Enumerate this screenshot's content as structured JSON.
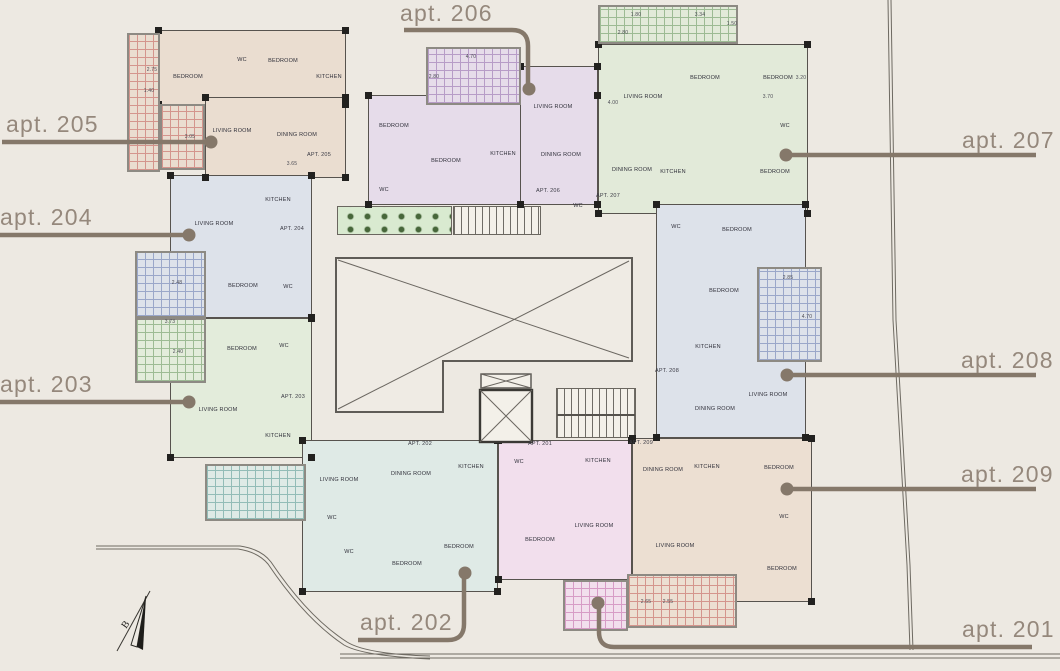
{
  "page": {
    "background": "#EDE9E2"
  },
  "callouts": [
    {
      "id": "205",
      "label": "apt. 205"
    },
    {
      "id": "204",
      "label": "apt. 204"
    },
    {
      "id": "203",
      "label": "apt. 203"
    },
    {
      "id": "206",
      "label": "apt. 206"
    },
    {
      "id": "207",
      "label": "apt. 207"
    },
    {
      "id": "208",
      "label": "apt. 208"
    },
    {
      "id": "209",
      "label": "apt. 209"
    },
    {
      "id": "202",
      "label": "apt. 202"
    },
    {
      "id": "201",
      "label": "apt. 201"
    }
  ],
  "compass": {
    "label": "B"
  },
  "units": [
    {
      "id": "apt-205",
      "fill": "#EADDD0",
      "rects": [
        [
          158,
          30,
          188,
          75
        ],
        [
          205,
          97,
          141,
          81
        ]
      ],
      "apt_label": {
        "t": "APT. 205",
        "x": 319,
        "y": 156
      },
      "rooms": [
        {
          "t": "BEDROOM",
          "x": 188,
          "y": 78
        },
        {
          "t": "WC",
          "x": 242,
          "y": 61
        },
        {
          "t": "BEDROOM",
          "x": 283,
          "y": 62
        },
        {
          "t": "KITCHEN",
          "x": 329,
          "y": 78
        },
        {
          "t": "LIVING ROOM",
          "x": 232,
          "y": 132
        },
        {
          "t": "DINING ROOM",
          "x": 297,
          "y": 136
        }
      ]
    },
    {
      "id": "apt-206",
      "fill": "#E6DCEA",
      "rects": [
        [
          368,
          95,
          230,
          110
        ],
        [
          520,
          66,
          78,
          139
        ]
      ],
      "apt_label": {
        "t": "APT. 206",
        "x": 548,
        "y": 192
      },
      "rooms": [
        {
          "t": "BEDROOM",
          "x": 394,
          "y": 127
        },
        {
          "t": "BEDROOM",
          "x": 446,
          "y": 162
        },
        {
          "t": "KITCHEN",
          "x": 503,
          "y": 155
        },
        {
          "t": "LIVING ROOM",
          "x": 553,
          "y": 108
        },
        {
          "t": "DINING ROOM",
          "x": 561,
          "y": 156
        },
        {
          "t": "WC",
          "x": 384,
          "y": 191
        },
        {
          "t": "WC",
          "x": 578,
          "y": 207
        }
      ]
    },
    {
      "id": "apt-207",
      "fill": "#E2EAD9",
      "rects": [
        [
          598,
          44,
          210,
          170
        ]
      ],
      "apt_label": {
        "t": "APT. 207",
        "x": 608,
        "y": 197
      },
      "rooms": [
        {
          "t": "LIVING ROOM",
          "x": 643,
          "y": 98
        },
        {
          "t": "BEDROOM",
          "x": 705,
          "y": 79
        },
        {
          "t": "BEDROOM",
          "x": 778,
          "y": 79
        },
        {
          "t": "WC",
          "x": 785,
          "y": 127
        },
        {
          "t": "DINING ROOM",
          "x": 632,
          "y": 171
        },
        {
          "t": "KITCHEN",
          "x": 673,
          "y": 173
        },
        {
          "t": "BEDROOM",
          "x": 775,
          "y": 173
        }
      ]
    },
    {
      "id": "apt-204",
      "fill": "#DDE2EA",
      "rects": [
        [
          170,
          175,
          142,
          143
        ]
      ],
      "apt_label": {
        "t": "APT. 204",
        "x": 292,
        "y": 230
      },
      "rooms": [
        {
          "t": "LIVING ROOM",
          "x": 214,
          "y": 225
        },
        {
          "t": "KITCHEN",
          "x": 278,
          "y": 201
        },
        {
          "t": "BEDROOM",
          "x": 243,
          "y": 287
        },
        {
          "t": "WC",
          "x": 288,
          "y": 288
        }
      ]
    },
    {
      "id": "apt-203",
      "fill": "#E3ECDB",
      "rects": [
        [
          170,
          318,
          142,
          140
        ]
      ],
      "apt_label": {
        "t": "APT. 203",
        "x": 293,
        "y": 398
      },
      "rooms": [
        {
          "t": "BEDROOM",
          "x": 242,
          "y": 350
        },
        {
          "t": "WC",
          "x": 284,
          "y": 347
        },
        {
          "t": "LIVING ROOM",
          "x": 218,
          "y": 411
        },
        {
          "t": "KITCHEN",
          "x": 278,
          "y": 437
        }
      ]
    },
    {
      "id": "apt-208",
      "fill": "#DDE2EA",
      "rects": [
        [
          656,
          204,
          150,
          234
        ]
      ],
      "apt_label": {
        "t": "APT. 208",
        "x": 667,
        "y": 372
      },
      "rooms": [
        {
          "t": "WC",
          "x": 676,
          "y": 228
        },
        {
          "t": "BEDROOM",
          "x": 737,
          "y": 231
        },
        {
          "t": "BEDROOM",
          "x": 724,
          "y": 292
        },
        {
          "t": "KITCHEN",
          "x": 708,
          "y": 348
        },
        {
          "t": "DINING ROOM",
          "x": 715,
          "y": 410
        },
        {
          "t": "LIVING ROOM",
          "x": 768,
          "y": 396
        }
      ]
    },
    {
      "id": "apt-209",
      "fill": "#ECDFD2",
      "rects": [
        [
          632,
          438,
          180,
          164
        ]
      ],
      "apt_label": {
        "t": "APT. 209",
        "x": 641,
        "y": 444
      },
      "rooms": [
        {
          "t": "DINING ROOM",
          "x": 663,
          "y": 471
        },
        {
          "t": "KITCHEN",
          "x": 707,
          "y": 468
        },
        {
          "t": "BEDROOM",
          "x": 779,
          "y": 469
        },
        {
          "t": "WC",
          "x": 784,
          "y": 518
        },
        {
          "t": "LIVING ROOM",
          "x": 675,
          "y": 547
        },
        {
          "t": "BEDROOM",
          "x": 782,
          "y": 570
        }
      ]
    },
    {
      "id": "apt-202",
      "fill": "#DFEAE6",
      "rects": [
        [
          302,
          440,
          196,
          152
        ]
      ],
      "apt_label": {
        "t": "APT. 202",
        "x": 420,
        "y": 445
      },
      "rooms": [
        {
          "t": "LIVING ROOM",
          "x": 339,
          "y": 481
        },
        {
          "t": "DINING ROOM",
          "x": 411,
          "y": 475
        },
        {
          "t": "KITCHEN",
          "x": 471,
          "y": 468
        },
        {
          "t": "WC",
          "x": 332,
          "y": 519
        },
        {
          "t": "WC",
          "x": 349,
          "y": 553
        },
        {
          "t": "BEDROOM",
          "x": 407,
          "y": 565
        },
        {
          "t": "BEDROOM",
          "x": 459,
          "y": 548
        }
      ]
    },
    {
      "id": "apt-201",
      "fill": "#F2DFED",
      "rects": [
        [
          498,
          440,
          134,
          140
        ]
      ],
      "apt_label": {
        "t": "APT. 201",
        "x": 540,
        "y": 445
      },
      "rooms": [
        {
          "t": "WC",
          "x": 519,
          "y": 463
        },
        {
          "t": "KITCHEN",
          "x": 598,
          "y": 462
        },
        {
          "t": "LIVING ROOM",
          "x": 594,
          "y": 527
        },
        {
          "t": "BEDROOM",
          "x": 540,
          "y": 541
        }
      ]
    }
  ],
  "balconies": [
    {
      "unit": "apt-205",
      "x": 127,
      "y": 33,
      "w": 33,
      "h": 139,
      "line": "#D4958D",
      "fill": "#EADDD0"
    },
    {
      "unit": "apt-205",
      "x": 160,
      "y": 104,
      "w": 45,
      "h": 66,
      "line": "#D4958D",
      "fill": "#EADDD0"
    },
    {
      "unit": "apt-206",
      "x": 426,
      "y": 47,
      "w": 95,
      "h": 58,
      "line": "#B79CC7",
      "fill": "#E6DCEA"
    },
    {
      "unit": "apt-207",
      "x": 598,
      "y": 5,
      "w": 140,
      "h": 39,
      "line": "#9DBB94",
      "fill": "#E2EAD9"
    },
    {
      "unit": "apt-204",
      "x": 135,
      "y": 251,
      "w": 71,
      "h": 67,
      "line": "#9AA7C9",
      "fill": "#DDE2EA"
    },
    {
      "unit": "apt-203",
      "x": 135,
      "y": 318,
      "w": 71,
      "h": 65,
      "line": "#9DBB94",
      "fill": "#E3ECDB"
    },
    {
      "unit": "apt-202",
      "x": 205,
      "y": 464,
      "w": 101,
      "h": 57,
      "line": "#93BCB7",
      "fill": "#DFEAE6"
    },
    {
      "unit": "apt-208",
      "x": 757,
      "y": 267,
      "w": 65,
      "h": 95,
      "line": "#9AA7C9",
      "fill": "#DDE2EA"
    },
    {
      "unit": "apt-209",
      "x": 627,
      "y": 574,
      "w": 110,
      "h": 54,
      "line": "#D4958D",
      "fill": "#ECDFD2"
    },
    {
      "unit": "apt-201",
      "x": 563,
      "y": 580,
      "w": 65,
      "h": 51,
      "line": "#D79CC6",
      "fill": "#F2DFED"
    }
  ],
  "dimensions": [
    {
      "t": "2.75",
      "x": 152,
      "y": 70
    },
    {
      "t": "1.40",
      "x": 149,
      "y": 91
    },
    {
      "t": "3.05",
      "x": 190,
      "y": 137
    },
    {
      "t": "3.65",
      "x": 292,
      "y": 164
    },
    {
      "t": "4.70",
      "x": 471,
      "y": 57
    },
    {
      "t": "2.80",
      "x": 434,
      "y": 77
    },
    {
      "t": "1.80",
      "x": 636,
      "y": 15
    },
    {
      "t": "3.34",
      "x": 700,
      "y": 15
    },
    {
      "t": "1.50",
      "x": 732,
      "y": 24
    },
    {
      "t": "2.80",
      "x": 623,
      "y": 33
    },
    {
      "t": "4.00",
      "x": 613,
      "y": 103
    },
    {
      "t": "3.70",
      "x": 768,
      "y": 97
    },
    {
      "t": "3.20",
      "x": 801,
      "y": 78
    },
    {
      "t": "2.48",
      "x": 177,
      "y": 283
    },
    {
      "t": "3.73",
      "x": 170,
      "y": 322
    },
    {
      "t": "2.40",
      "x": 178,
      "y": 352
    },
    {
      "t": "2.85",
      "x": 788,
      "y": 278
    },
    {
      "t": "4.70",
      "x": 807,
      "y": 317
    },
    {
      "t": "2.65",
      "x": 646,
      "y": 602
    },
    {
      "t": "2.55",
      "x": 668,
      "y": 602
    }
  ]
}
